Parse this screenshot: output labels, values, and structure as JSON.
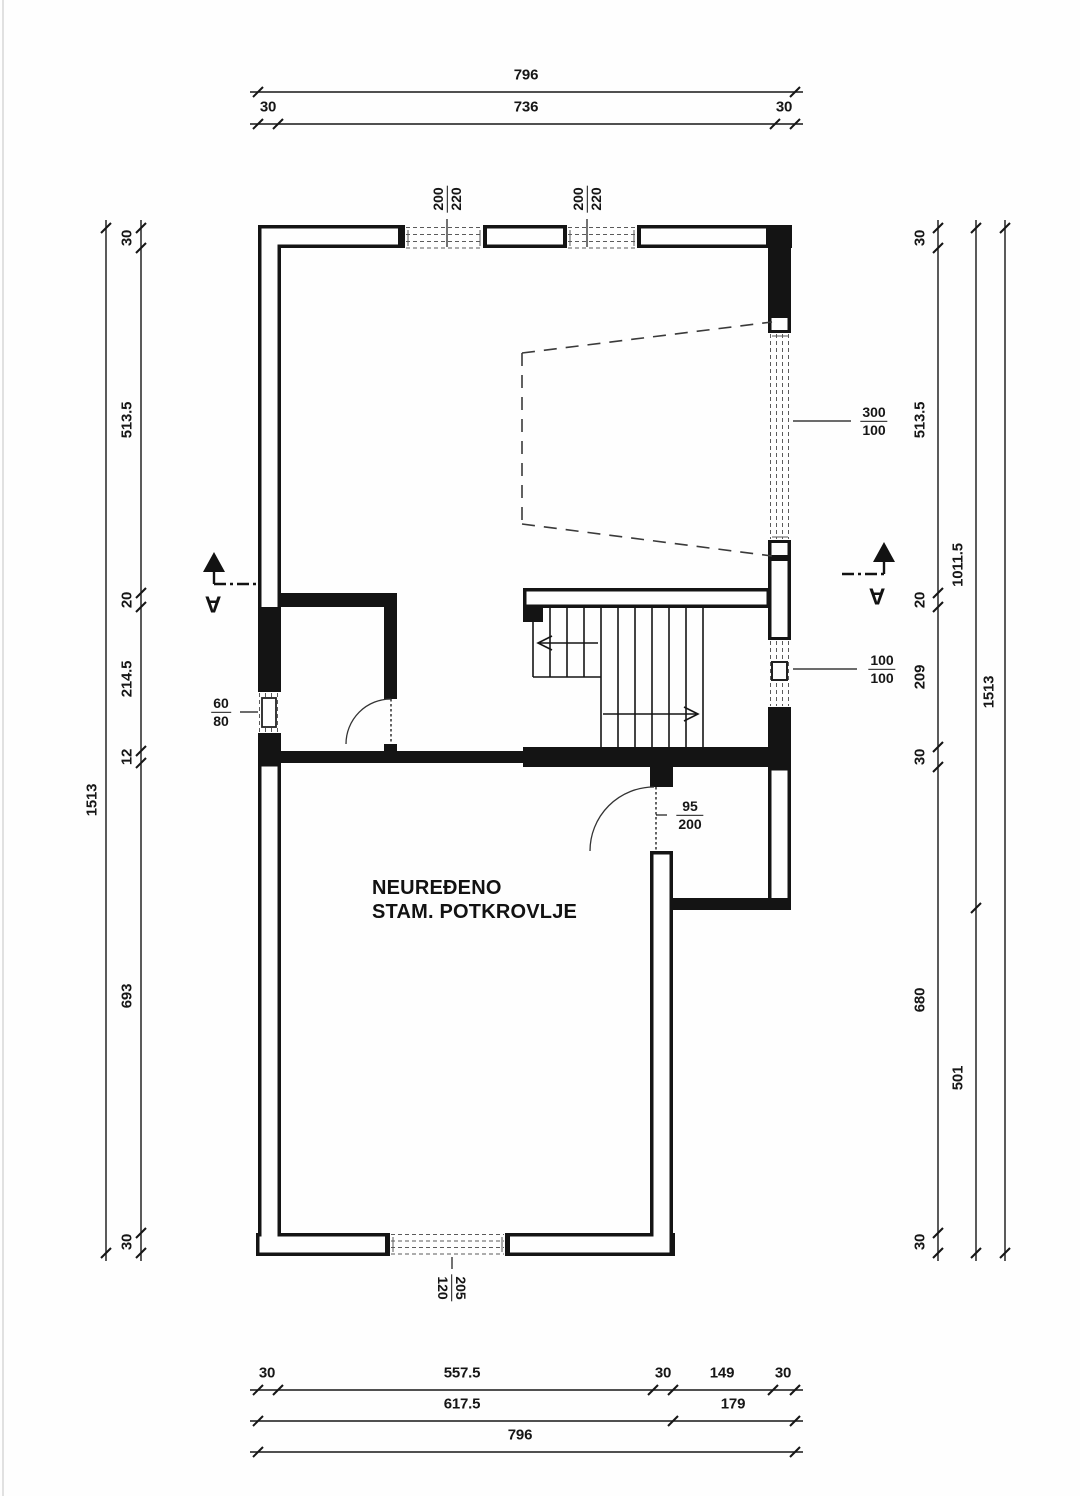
{
  "plan": {
    "room_label_line1": "NEUREĐENO",
    "room_label_line2": "STAM. POTKROVLJE",
    "section_letter": "A"
  },
  "openings": {
    "window_top_left": {
      "num": "200",
      "den": "220"
    },
    "window_top_right": {
      "num": "200",
      "den": "220"
    },
    "window_right_large": {
      "num": "300",
      "den": "100"
    },
    "window_right_small": {
      "num": "100",
      "den": "100"
    },
    "window_left_small": {
      "num": "60",
      "den": "80"
    },
    "window_bottom": {
      "num": "205",
      "den": "120"
    },
    "door_main": {
      "num": "95",
      "den": "200"
    }
  },
  "dims": {
    "top_total": "796",
    "top_parts": [
      "30",
      "736",
      "30"
    ],
    "left_total": "1513",
    "left_parts": [
      "30",
      "513.5",
      "20",
      "214.5",
      "12",
      "693",
      "30"
    ],
    "right_parts": [
      "30",
      "513.5",
      "20",
      "209",
      "30",
      "680",
      "30"
    ],
    "right_mid": [
      "1011.5",
      "501"
    ],
    "right_total": "1513",
    "bottom_row1": [
      "30",
      "557.5",
      "30",
      "149",
      "30"
    ],
    "bottom_row2": [
      "617.5",
      "179"
    ],
    "bottom_total": "796"
  }
}
